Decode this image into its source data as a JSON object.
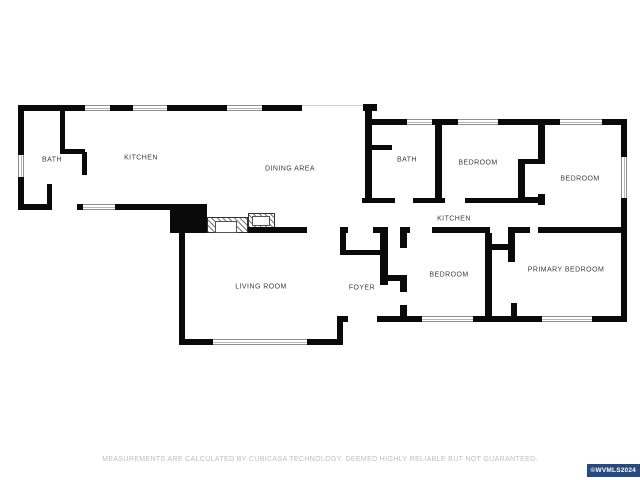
{
  "floorplan": {
    "rooms": {
      "bath_left": "BATH",
      "kitchen_left": "KITCHEN",
      "dining": "DINING AREA",
      "bath_right": "BATH",
      "bedroom_top": "BEDROOM",
      "bedroom_right": "BEDROOM",
      "kitchen_right": "KITCHEN",
      "bedroom_bottom": "BEDROOM",
      "primary_bedroom": "PRIMARY BEDROOM",
      "living_room": "LIVING ROOM",
      "foyer": "FOYER"
    },
    "wall_color": "#0a0a0a"
  },
  "footer": {
    "disclaimer": "MEASUREMENTS ARE CALCULATED BY CUBICASA TECHNOLOGY, DEEMED HIGHLY RELIABLE BUT NOT GUARANTEED."
  },
  "watermark": {
    "label": "©WVMLS2024",
    "background": "#27497f",
    "color": "#ffffff"
  }
}
